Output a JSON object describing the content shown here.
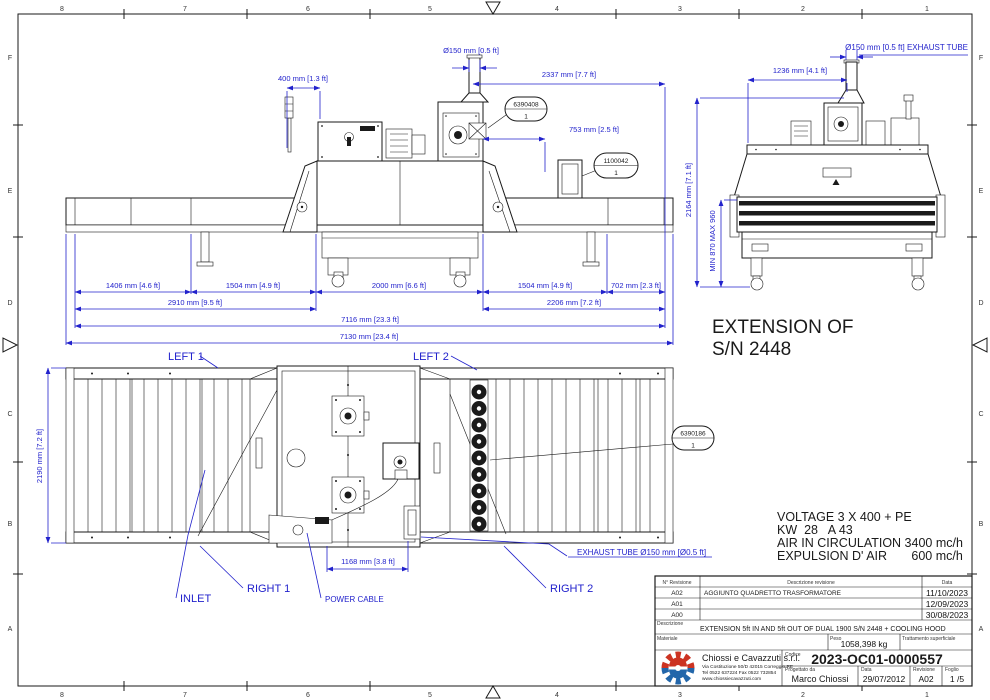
{
  "grid": {
    "cols": [
      "8",
      "7",
      "6",
      "5",
      "4",
      "3",
      "2",
      "1"
    ],
    "rows": [
      "F",
      "E",
      "D",
      "C",
      "B",
      "A"
    ]
  },
  "side": {
    "dimD150": "Ø150 mm [0.5 ft]",
    "dim400": "400 mm [1.3 ft]",
    "dim2337": "2337 mm [7.7 ft]",
    "dim753": "753 mm [2.5 ft]",
    "dim1406": "1406 mm [4.6 ft]",
    "dim1504a": "1504 mm [4.9 ft]",
    "dim2000": "2000 mm [6.6 ft]",
    "dim1504b": "1504 mm [4.9 ft]",
    "dim702": "702 mm [2.3 ft]",
    "dim2910": "2910 mm [9.5 ft]",
    "dim2206": "2206 mm [7.2 ft]",
    "dim7116": "7116 mm [23.3 ft]",
    "dim7130": "7130 mm [23.4 ft]",
    "balloon1No": "6390408",
    "balloon1Qty": "1",
    "balloon2No": "1100042",
    "balloon2Qty": "1"
  },
  "front": {
    "dimExhaust": "Ø150 mm [0.5 ft] EXHAUST TUBE",
    "dim1236": "1236 mm [4.1 ft]",
    "dim2164": "2164 mm [7.1 ft]",
    "dimMinMax": "MIN 870 MAX 960"
  },
  "plan": {
    "left1": "LEFT 1",
    "left2": "LEFT 2",
    "inlet": "INLET",
    "right1": "RIGHT 1",
    "right2": "RIGHT 2",
    "powerCable": "POWER CABLE",
    "exhaustTube": "EXHAUST TUBE Ø150 mm [Ø0.5 ft]",
    "dim1168": "1168 mm [3.8 ft]",
    "dim2190": "2190 mm [7.2 ft]",
    "balloonNo": "6390186",
    "balloonQty": "1"
  },
  "notes": {
    "extension1": "EXTENSION OF",
    "extension2": "S/N 2448",
    "voltage": "VOLTAGE 3 X 400 + PE",
    "kw": "KW  28   A 43",
    "air": "AIR IN CIRCULATION 3400 mc/h",
    "expulsion": "EXPULSION D' AIR       600 mc/h"
  },
  "titleBlock": {
    "revHeaderNo": "N° Revisione",
    "revHeaderDesc": "Descrizione revisione",
    "revHeaderDate": "Data",
    "revisions": [
      {
        "no": "A02",
        "desc": "AGGIUNTO QUADRETTO TRASFORMATORE",
        "date": "11/10/2023"
      },
      {
        "no": "A01",
        "desc": "",
        "date": "12/09/2023"
      },
      {
        "no": "A00",
        "desc": "",
        "date": "30/08/2023"
      }
    ],
    "descrizioneLabel": "Descrizione",
    "descrizione": "EXTENSION 5ft IN AND 5ft OUT OF DUAL 1900 S/N 2448 + COOLING HOOD",
    "materialeLabel": "Materiale",
    "pesoLabel": "Peso",
    "peso": "1058,398 kg",
    "trattamentoLabel": "Trattamento superficiale",
    "companyName": "Chiossi e Cavazzuti s.r.l.",
    "companyAddress": "Via Costituzione 50/D 42015 Correggio RE",
    "companyPhone": "Tel 0522 637224 Fax 0522 732854",
    "companyWeb": "www.chiossiecavazzuti.com",
    "codiceLabel": "Codice",
    "codice": "2023-OC01-0000557",
    "progettatoLabel": "Progettato da",
    "progettato": "Marco Chiossi",
    "dataLabel": "Data",
    "data": "29/07/2012",
    "revisioneLabel": "Revisione",
    "revisione": "A02",
    "foglioLabel": "Foglio",
    "foglio": "1 /5"
  },
  "colors": {
    "dim": "#2222cc",
    "line": "#1a1a1a",
    "logoRed": "#cc3322",
    "logoBlue": "#2266aa"
  }
}
